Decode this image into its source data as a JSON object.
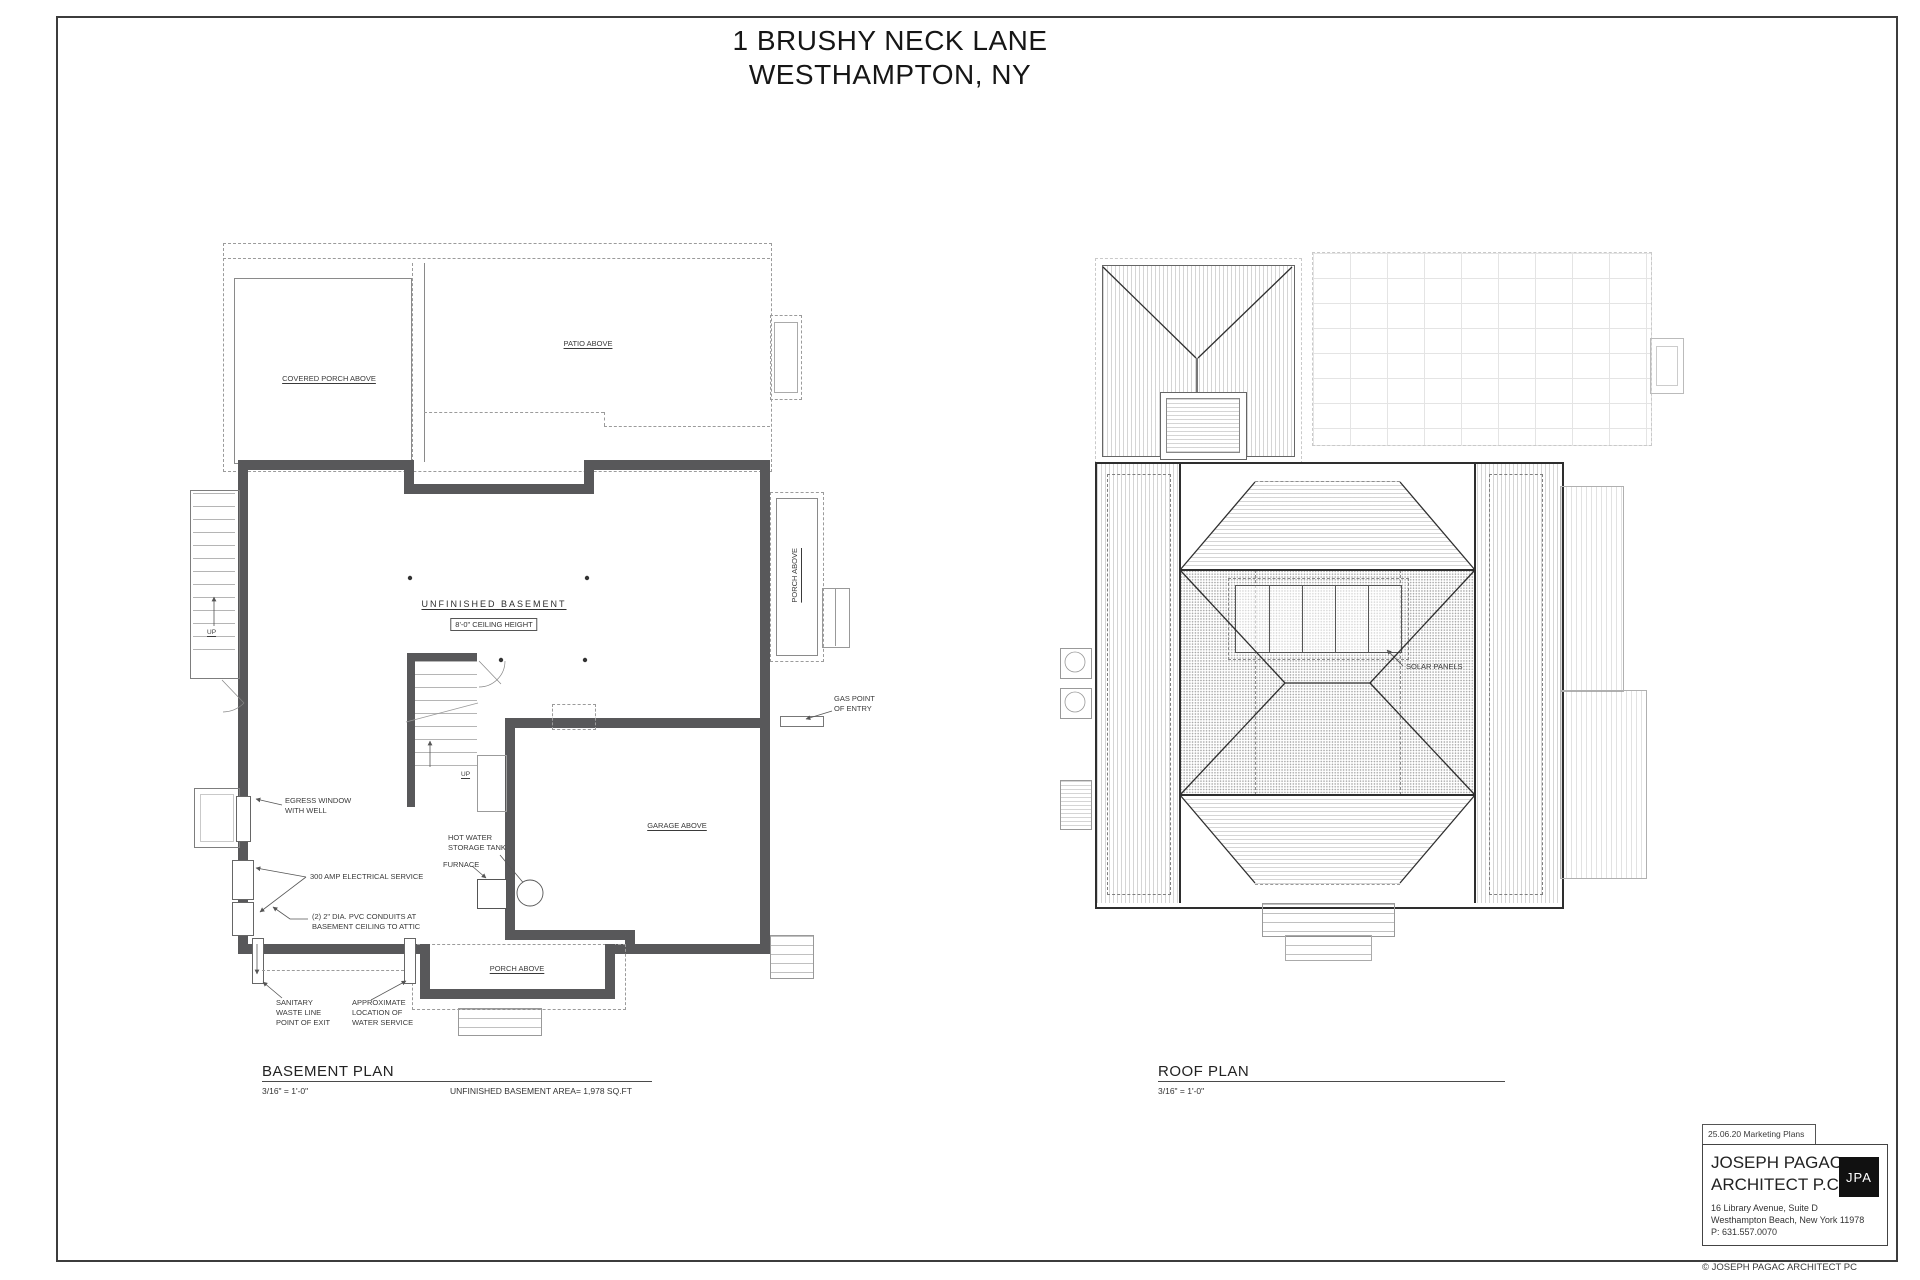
{
  "colors": {
    "wall": "#58585a",
    "ink": "#2e2e2e",
    "leader": "#555555",
    "dash": "#9b9b9b",
    "paper": "#ffffff",
    "logo_bg": "#111111"
  },
  "sheet": {
    "title_line1": "1 BRUSHY NECK LANE",
    "title_line2": "WESTHAMPTON, NY",
    "copyright": "© JOSEPH PAGAC ARCHITECT PC"
  },
  "basement": {
    "plan_title": "BASEMENT PLAN",
    "plan_scale": "3/16\" = 1'-0\"",
    "area_note": "UNFINISHED BASEMENT AREA= 1,978 SQ.FT",
    "room_label": "UNFINISHED BASEMENT",
    "ceiling_note": "8'-0\" CEILING HEIGHT",
    "covered_porch_label": "COVERED PORCH ABOVE",
    "patio_label": "PATIO ABOVE",
    "side_porch_label": "PORCH ABOVE",
    "bottom_porch_label": "PORCH ABOVE",
    "garage_label": "GARAGE ABOVE",
    "up_label_left": "UP",
    "up_label_center": "UP",
    "egress_line1": "EGRESS WINDOW",
    "egress_line2": "WITH WELL",
    "electrical_note": "300 AMP ELECTRICAL SERVICE",
    "conduit_line1": "(2) 2\" DIA. PVC CONDUITS AT",
    "conduit_line2": "BASEMENT CEILING TO ATTIC",
    "hot_water_line1": "HOT WATER",
    "hot_water_line2": "STORAGE TANK",
    "furnace_note": "FURNACE",
    "gas_line1": "GAS POINT",
    "gas_line2": "OF ENTRY",
    "sanitary_line1": "SANITARY",
    "sanitary_line2": "WASTE LINE",
    "sanitary_line3": "POINT OF EXIT",
    "water_line1": "APPROXIMATE",
    "water_line2": "LOCATION OF",
    "water_line3": "WATER SERVICE"
  },
  "roof": {
    "plan_title": "ROOF PLAN",
    "plan_scale": "3/16\" = 1'-0\"",
    "solar_label": "SOLAR PANELS"
  },
  "titleblock": {
    "revision": "25.06.20 Marketing Plans",
    "firm_line1": "JOSEPH PAGAC",
    "firm_line2": "ARCHITECT P.C.",
    "logo": "JPA",
    "address_line1": "16 Library Avenue, Suite D",
    "address_line2": "Westhampton Beach, New York  11978",
    "phone": "P: 631.557.0070"
  }
}
